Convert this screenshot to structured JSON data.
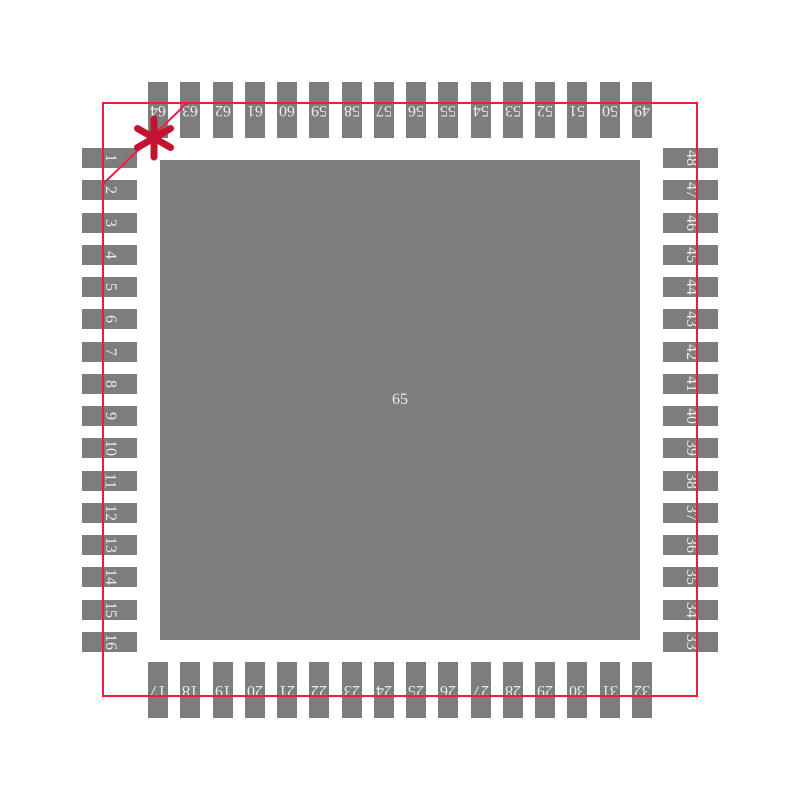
{
  "pins": {
    "top_row_left_to_right": [
      "64",
      "63",
      "62",
      "61",
      "60",
      "59",
      "58",
      "57",
      "56",
      "55",
      "54",
      "53",
      "52",
      "51",
      "50",
      "49"
    ],
    "left_column_top_to_bottom": [
      "1",
      "2",
      "3",
      "4",
      "5",
      "6",
      "7",
      "8",
      "9",
      "10",
      "11",
      "12",
      "13",
      "14",
      "15",
      "16"
    ],
    "right_column_top_to_bottom": [
      "48",
      "47",
      "46",
      "45",
      "44",
      "43",
      "42",
      "41",
      "40",
      "39",
      "38",
      "37",
      "36",
      "35",
      "34",
      "33"
    ],
    "bottom_row_left_to_right": [
      "17",
      "18",
      "19",
      "20",
      "21",
      "22",
      "23",
      "24",
      "25",
      "26",
      "27",
      "28",
      "29",
      "30",
      "31",
      "32"
    ],
    "center_pad": "65"
  },
  "markers": {
    "pin1_indicator": "asterisk"
  },
  "colors": {
    "background": "#ffffff",
    "pad_gray": "#7d7d7d",
    "pin_label": "#ededed",
    "outline_red": "#ed1c40",
    "pin1_marker_red": "#c41232"
  }
}
